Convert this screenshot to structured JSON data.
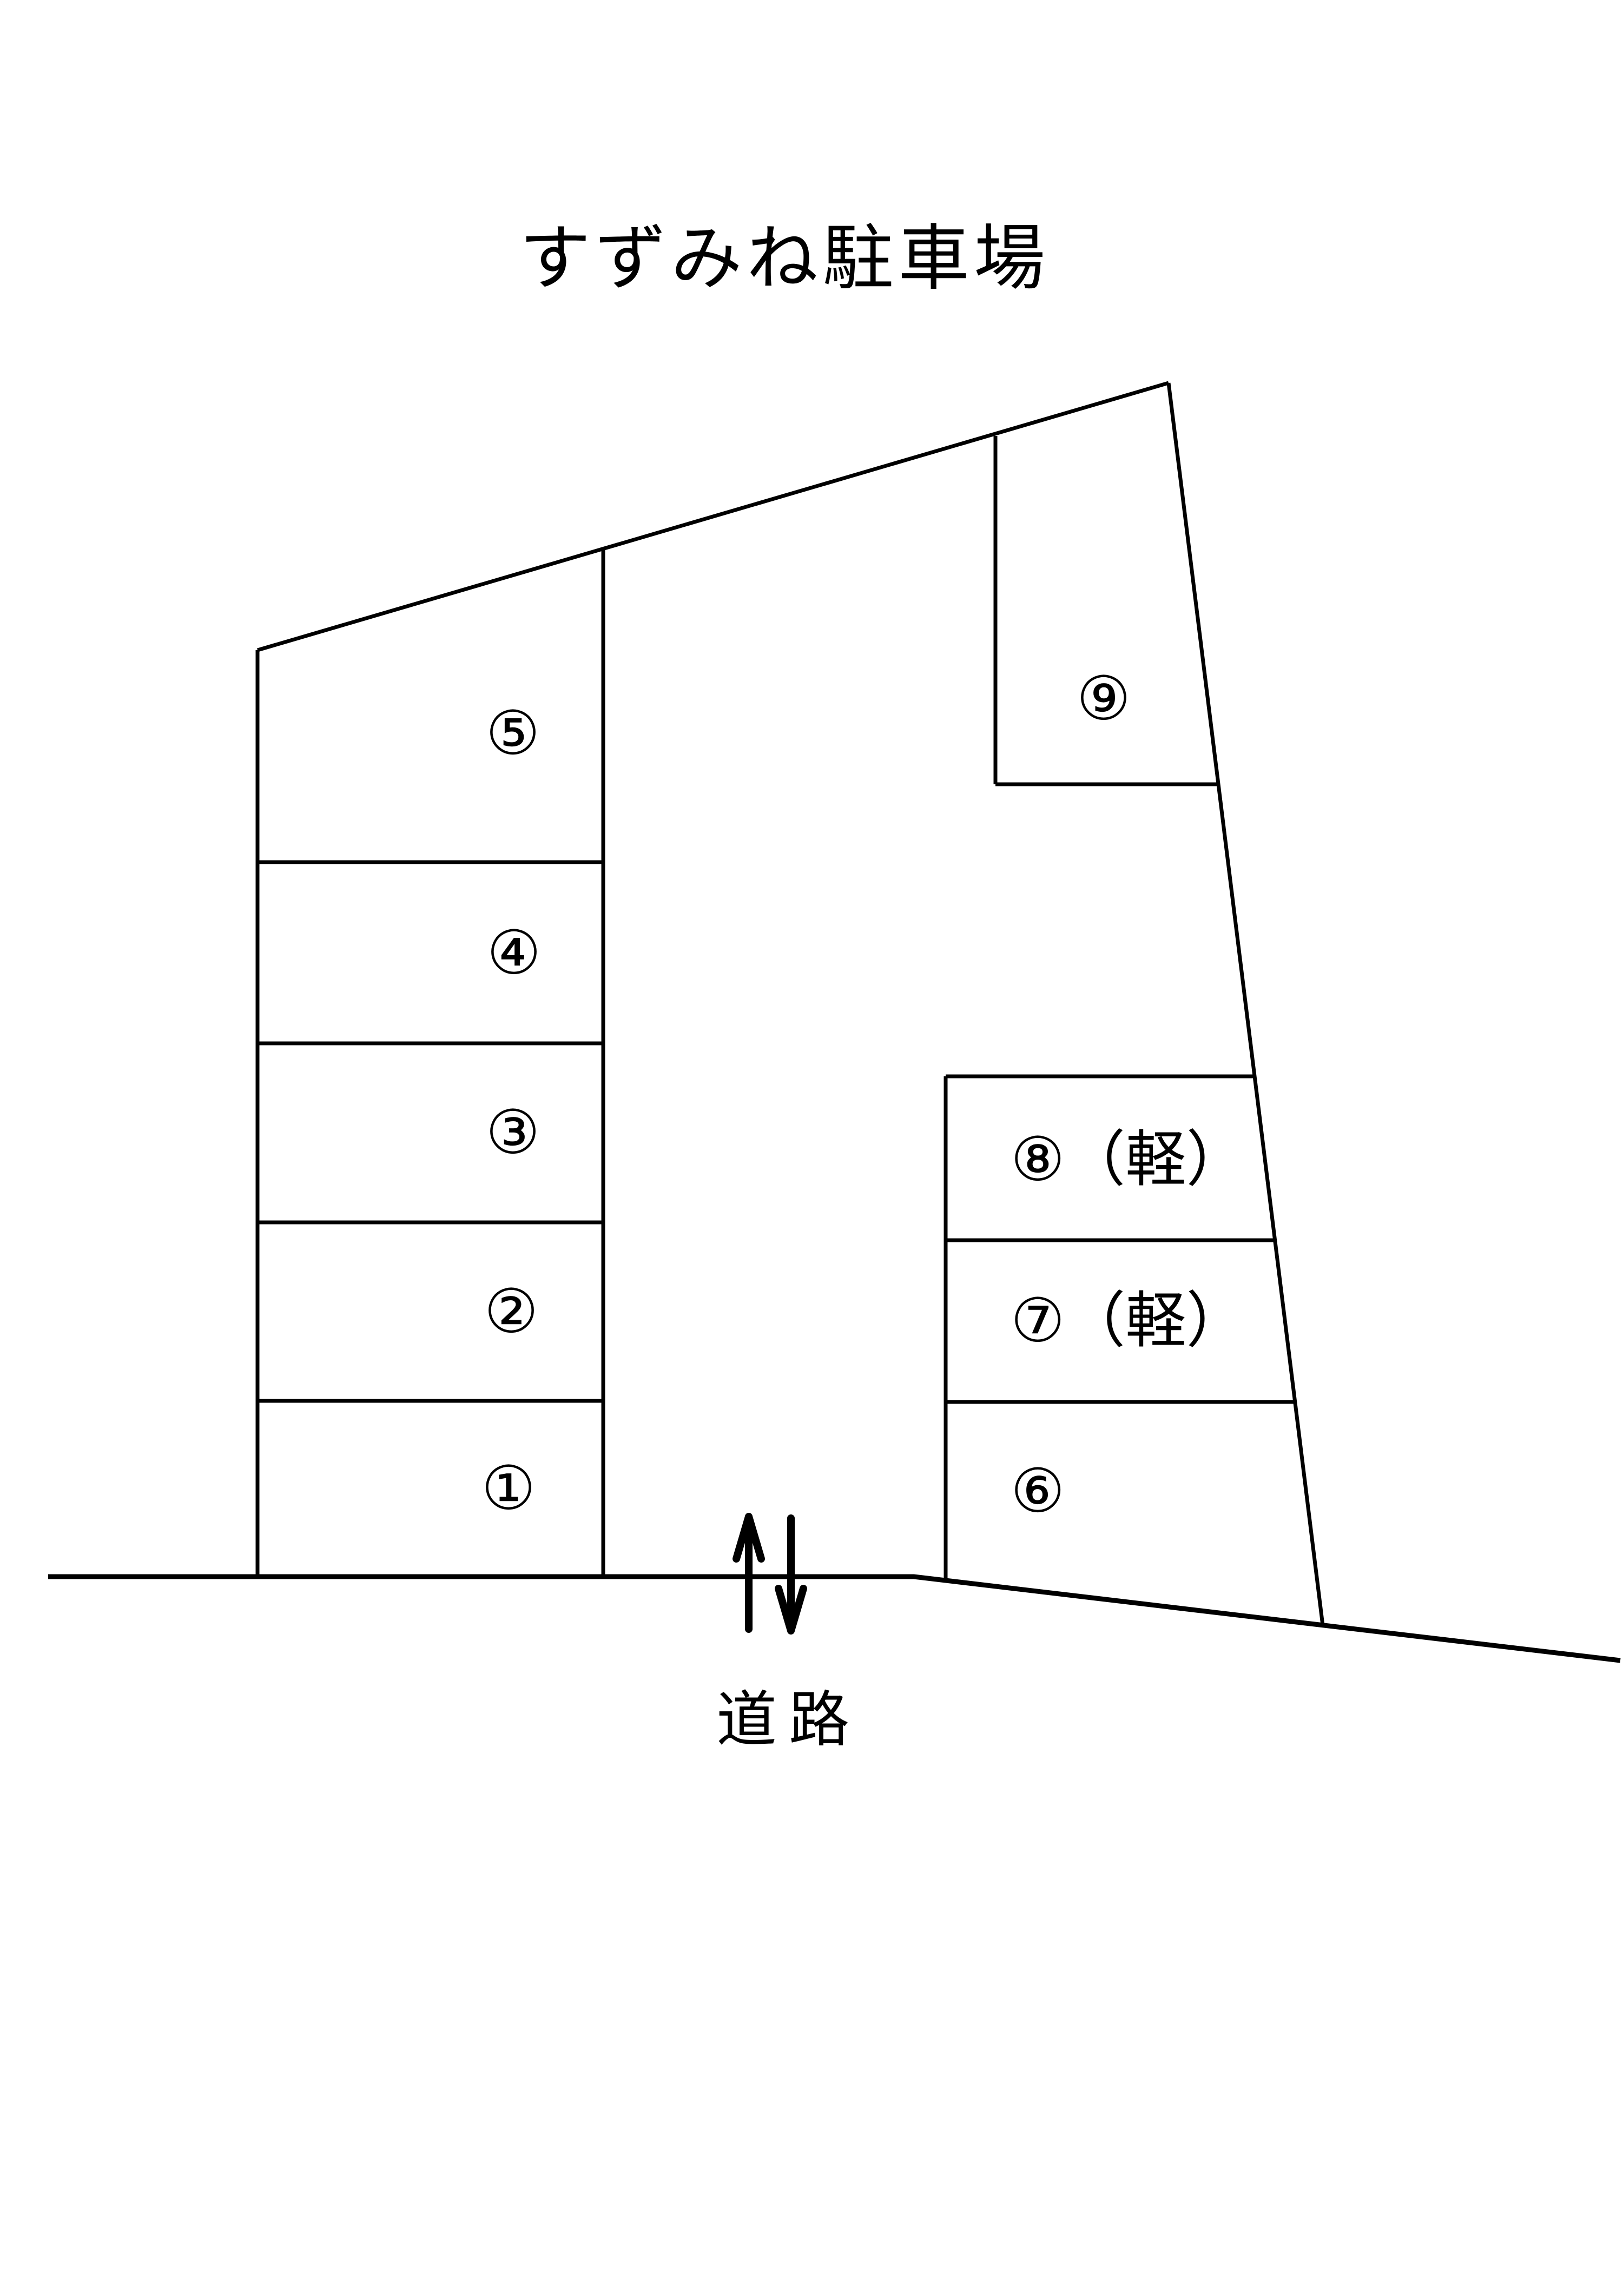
{
  "title": "すずみね駐車場",
  "road": {
    "label": "道路",
    "arrows": [
      "up-arrow",
      "down-arrow"
    ]
  },
  "spaces": [
    {
      "id": 1,
      "label": "①",
      "kei": false
    },
    {
      "id": 2,
      "label": "②",
      "kei": false
    },
    {
      "id": 3,
      "label": "③",
      "kei": false
    },
    {
      "id": 4,
      "label": "④",
      "kei": false
    },
    {
      "id": 5,
      "label": "⑤",
      "kei": false
    },
    {
      "id": 6,
      "label": "⑥",
      "kei": false
    },
    {
      "id": 7,
      "label": "⑦（軽）",
      "kei": true
    },
    {
      "id": 8,
      "label": "⑧（軽）",
      "kei": true
    },
    {
      "id": 9,
      "label": "⑨",
      "kei": false
    }
  ],
  "colors": {
    "line": "#000000",
    "text": "#000000",
    "background": "#ffffff"
  }
}
